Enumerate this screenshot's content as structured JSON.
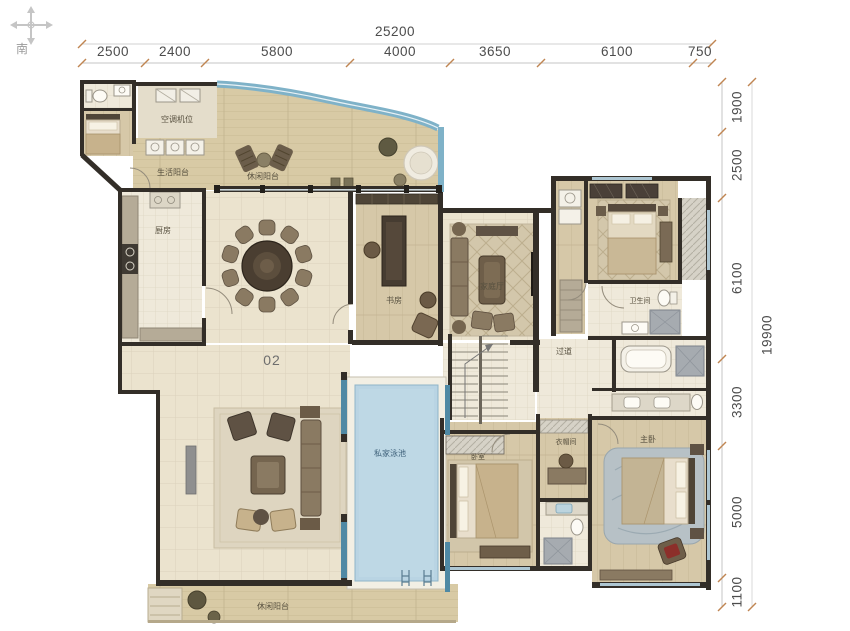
{
  "compass": {
    "south": "南"
  },
  "dimensions": {
    "top": {
      "total": "25200",
      "segments": [
        "2500",
        "2400",
        "5800",
        "4000",
        "3650",
        "6100",
        "750"
      ]
    },
    "right": {
      "total": "19900",
      "segments": [
        "1900",
        "2500",
        "6100",
        "3300",
        "5000",
        "1100"
      ]
    }
  },
  "unit": {
    "number": "02"
  },
  "rooms": {
    "ac_platform": "空调机位",
    "service_balcony": "生活阳台",
    "leisure_balcony": "休闲阳台",
    "kitchen": "厨房",
    "study": "书房",
    "family_room": "家庭厅",
    "hallway": "过道",
    "guest_bath": "卫生间",
    "closet": "衣帽间",
    "pool": "私家泳池",
    "terrace": "休闲阳台",
    "bedroom": "卧室",
    "master_bedroom": "主卧"
  },
  "colors": {
    "wall": "#332e28",
    "glass_accent": "#7fb2c8",
    "teal_wall": "#4f89a4",
    "pool_water": "#b9d4e3",
    "floor_tile": "#ebe3ce",
    "deck_wood": "#d8caa5",
    "dim_text": "#4c4c4c"
  }
}
